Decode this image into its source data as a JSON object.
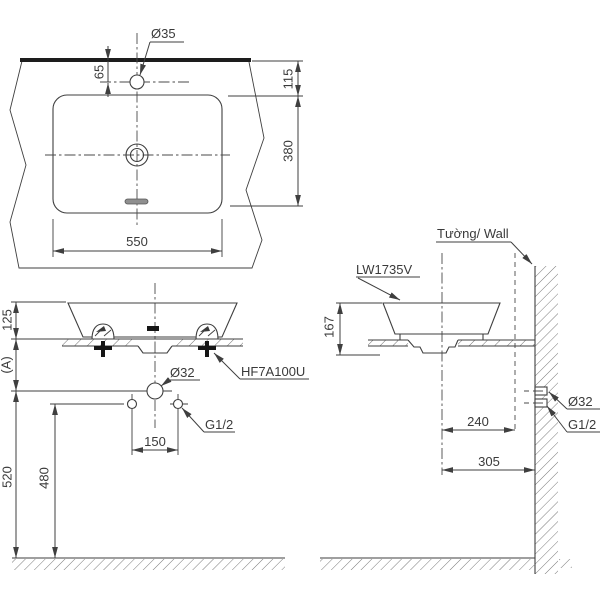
{
  "drawing_title": "Washbasin installation technical drawing",
  "plan_view": {
    "faucet_hole_label": "Ø35",
    "dim_hole_offset": "65",
    "dim_rim_to_basin": "115",
    "dim_basin_depth": "380",
    "dim_basin_width": "550"
  },
  "front_view": {
    "dim_basin_height": "125",
    "dim_a": "(A)",
    "drain_label": "Ø32",
    "fixture_label": "HF7A100U",
    "supply_label": "G1/2",
    "dim_supply_spacing": "150",
    "dim_drain_height": "520",
    "dim_supply_height": "480"
  },
  "side_view": {
    "model_label": "LW1735V",
    "wall_label": "Tường/ Wall",
    "dim_basin_height": "167",
    "dim_center_to_outlet": "240",
    "dim_center_to_wall": "305",
    "drain_label": "Ø32",
    "supply_label": "G1/2"
  },
  "colors": {
    "line": "#3f3f3f",
    "heavy_line": "#1d1d1d",
    "hatch": "#7a7a7a",
    "text": "#3a3a3a",
    "background": "#ffffff"
  }
}
